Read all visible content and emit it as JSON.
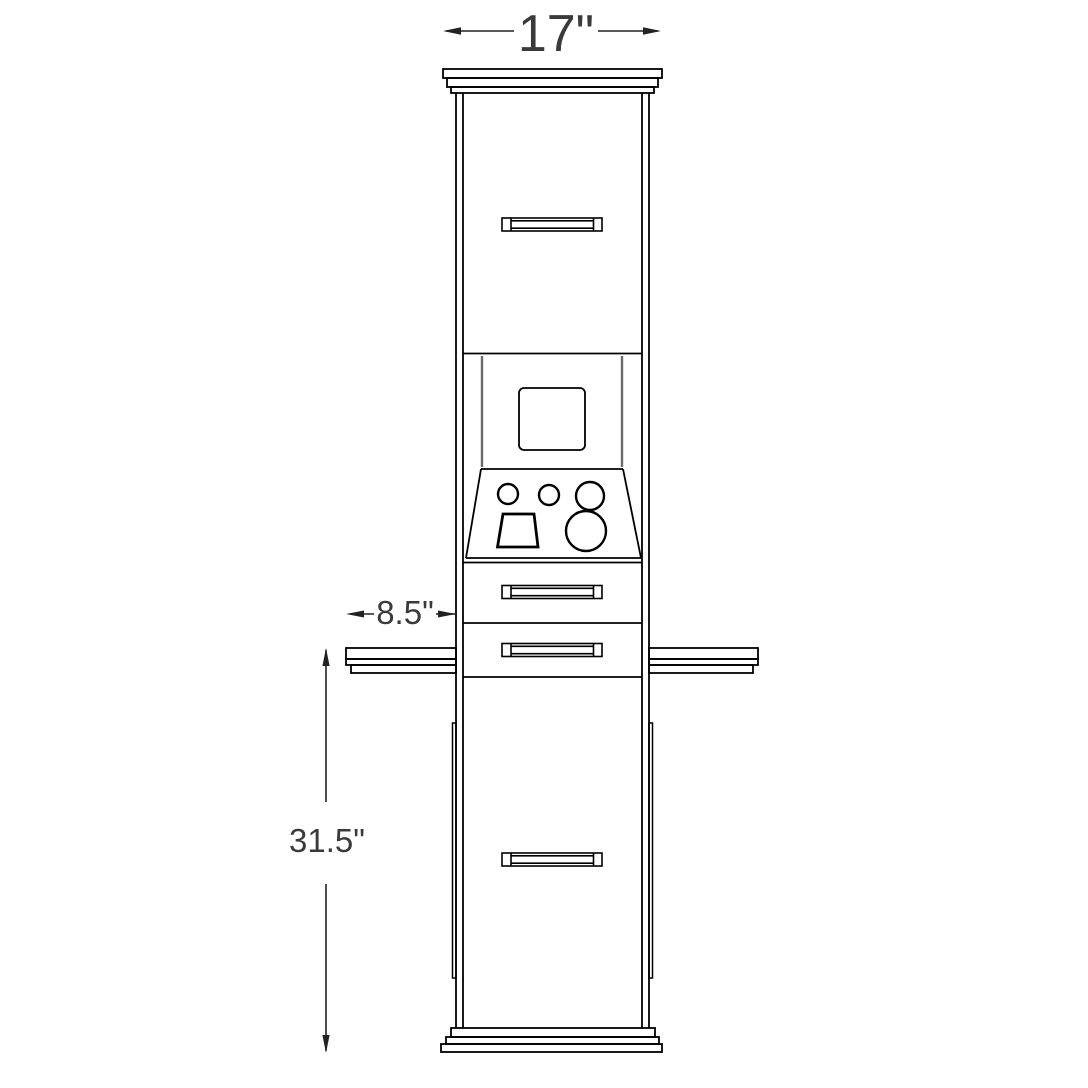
{
  "dimensions": {
    "top_width": "17\"",
    "counter_depth": "8.5\"",
    "counter_height": "31.5\""
  },
  "colors": {
    "outline": "#000000",
    "recess": "#6b6b6b",
    "dimension_text": "#3a3a3a",
    "background": "#ffffff"
  }
}
